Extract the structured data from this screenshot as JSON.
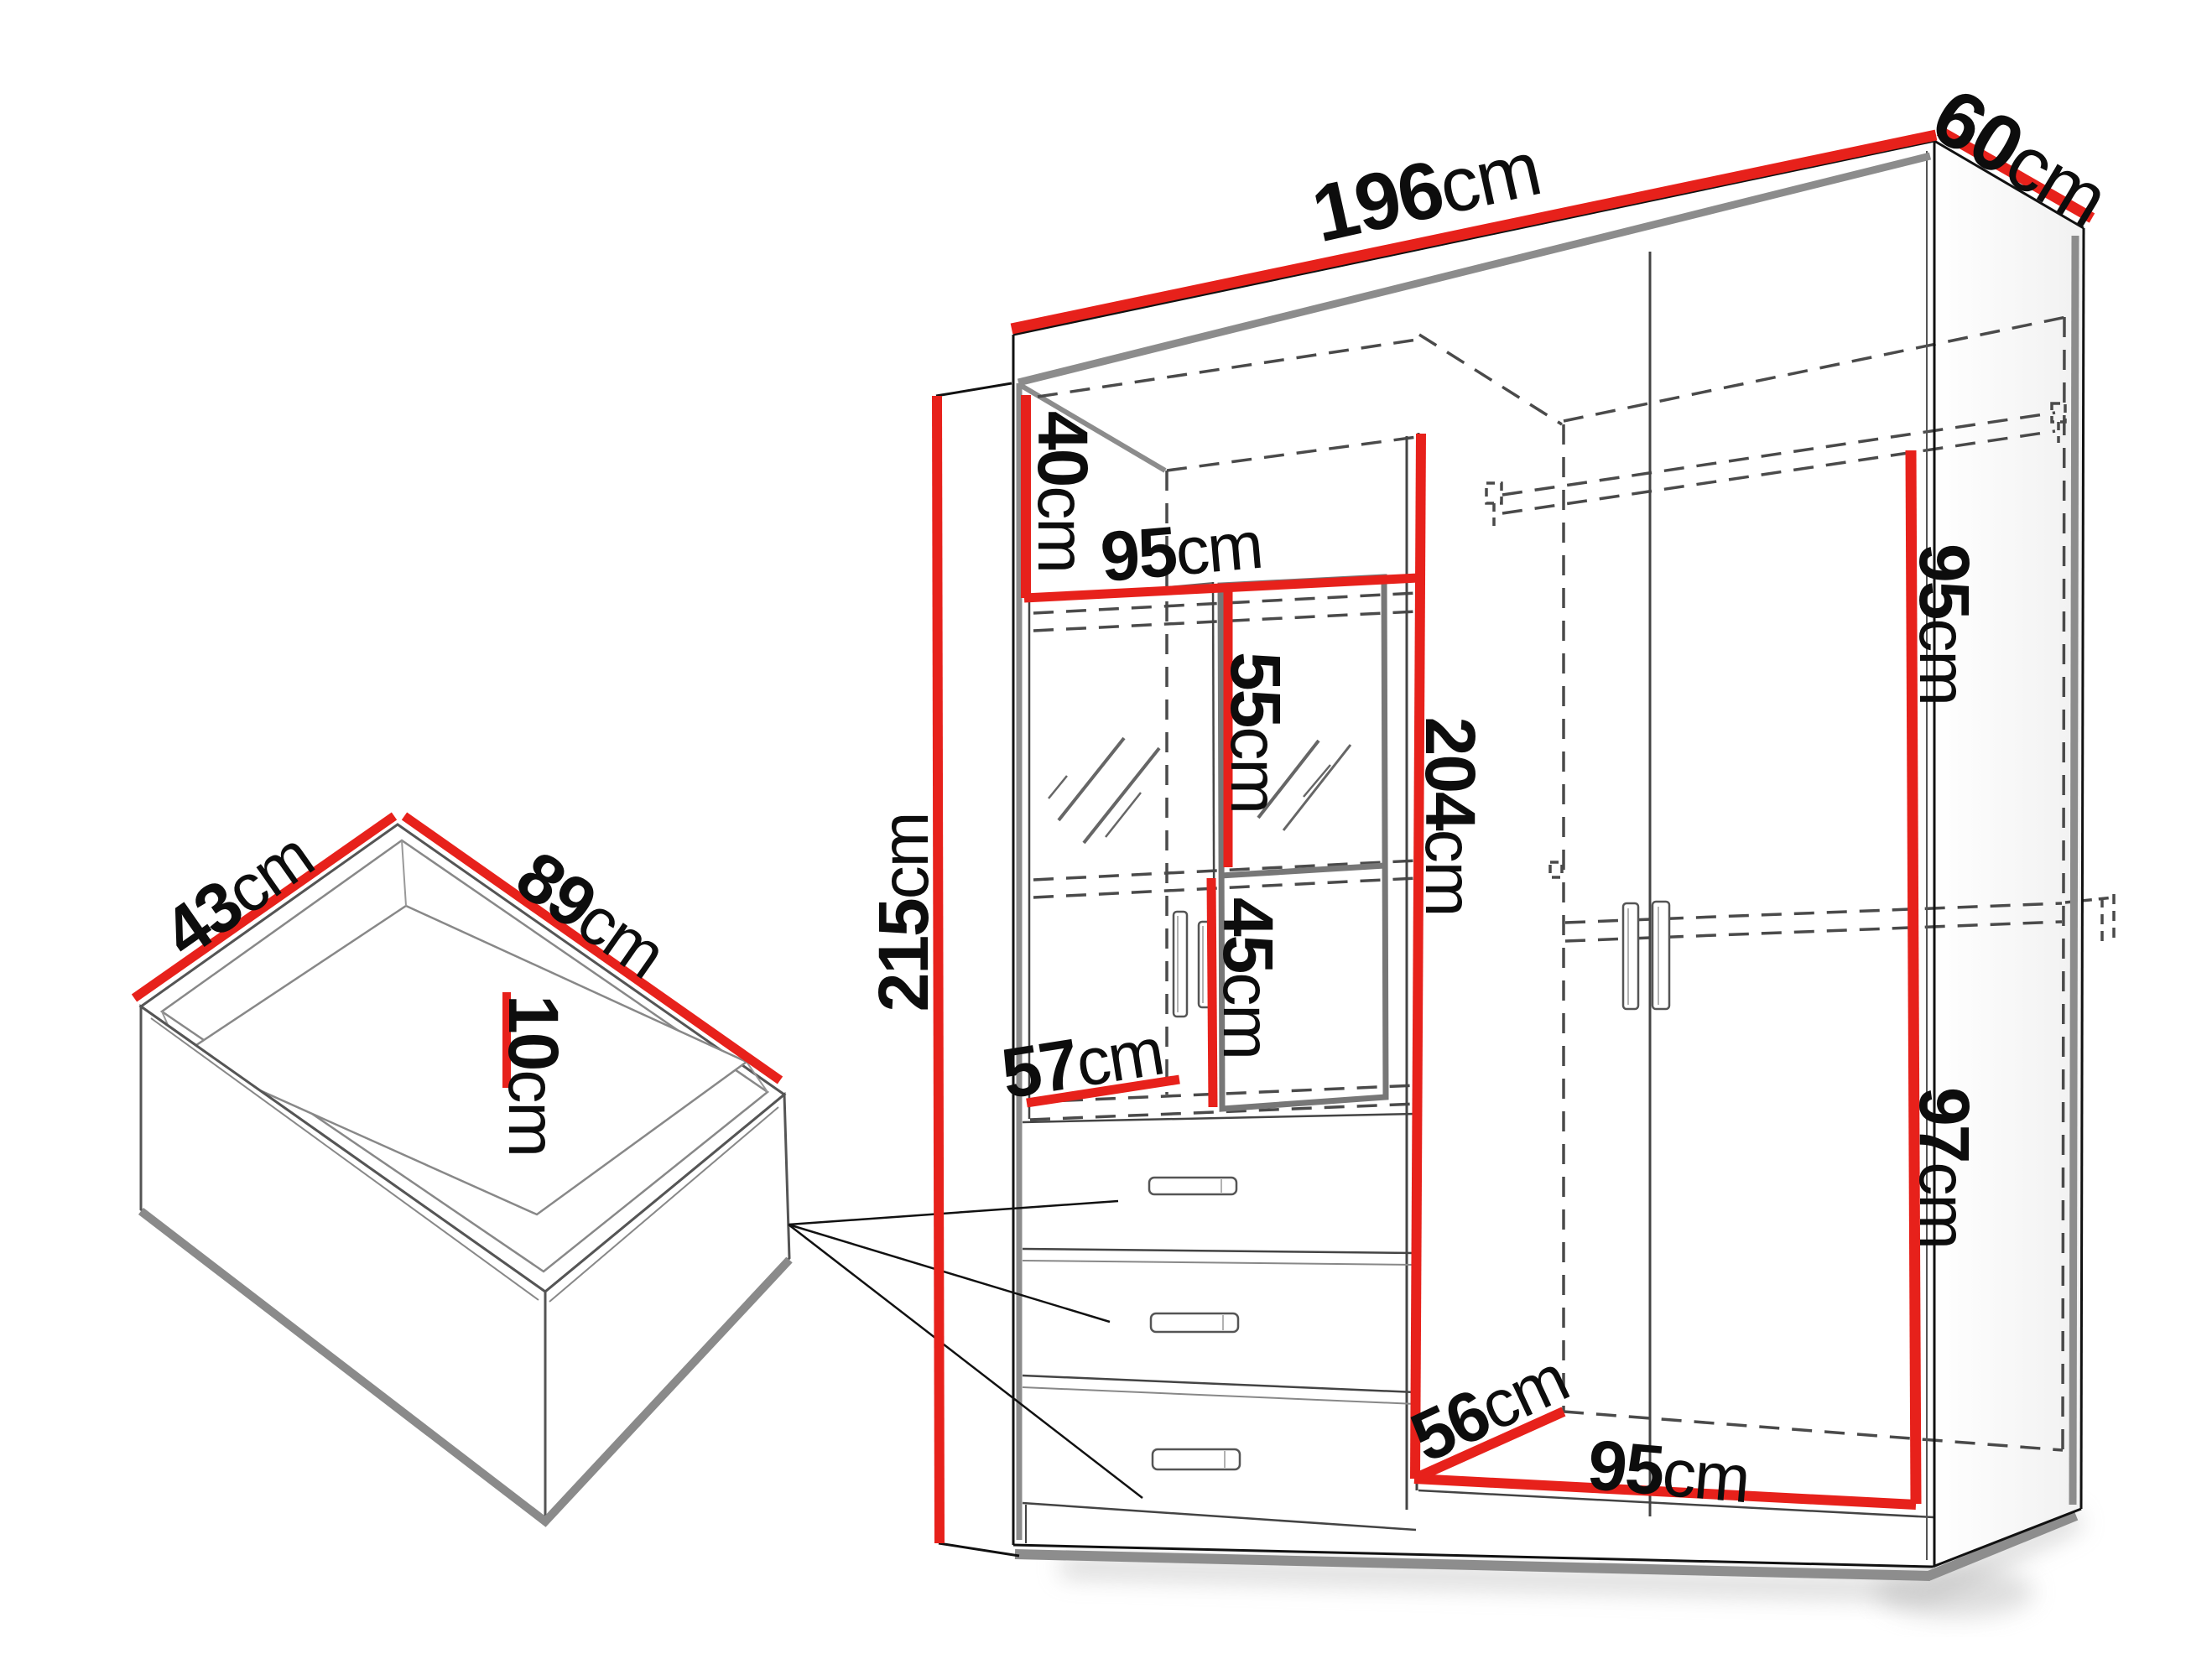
{
  "page": {
    "type": "furniture dimension diagram",
    "background": "#ffffff"
  },
  "colors": {
    "dimension_red": "#e7211b",
    "line_black": "#111111",
    "edge_gray": "#8c8c8c",
    "dash_gray": "#4a4a4a"
  },
  "wardrobe": {
    "dimensions": {
      "width": {
        "num": "196",
        "unit": "cm"
      },
      "depth": {
        "num": "60",
        "unit": "cm"
      },
      "height": {
        "num": "215",
        "unit": "cm"
      },
      "top_compartment_height": {
        "num": "40",
        "unit": "cm"
      },
      "left_section_width": {
        "num": "95",
        "unit": "cm"
      },
      "upper_glass_height": {
        "num": "55",
        "unit": "cm"
      },
      "interior_height": {
        "num": "204",
        "unit": "cm"
      },
      "right_upper_height": {
        "num": "95",
        "unit": "cm"
      },
      "lower_glass_height": {
        "num": "45",
        "unit": "cm"
      },
      "mirror_door_width": {
        "num": "57",
        "unit": "cm"
      },
      "right_lower_height": {
        "num": "97",
        "unit": "cm"
      },
      "interior_depth": {
        "num": "56",
        "unit": "cm"
      },
      "bottom_section_width": {
        "num": "95",
        "unit": "cm"
      }
    }
  },
  "drawer": {
    "dimensions": {
      "depth": {
        "num": "43",
        "unit": "cm"
      },
      "width": {
        "num": "89",
        "unit": "cm"
      },
      "height": {
        "num": "10",
        "unit": "cm"
      }
    }
  }
}
